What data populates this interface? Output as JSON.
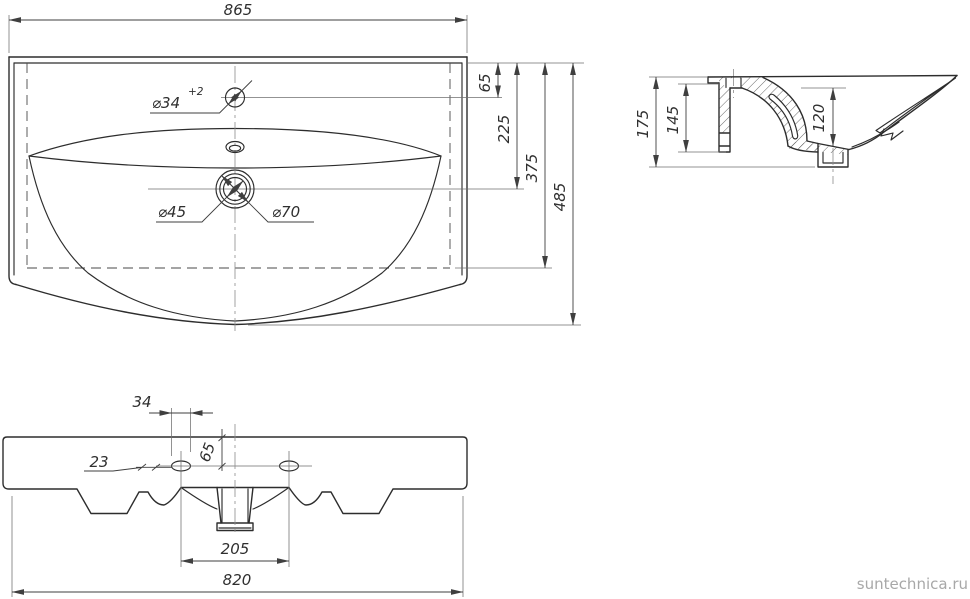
{
  "colors": {
    "line": "#2d2d2d",
    "dim": "#3f3f3f",
    "centerline": "#8c8c8c",
    "watermark": "#a8a8a8"
  },
  "plan_view": {
    "overall_width": "865",
    "faucet_hole_dia": "⌀34",
    "faucet_hole_tolerance": "+2",
    "drain_dia_inner": "⌀45",
    "drain_dia_outer": "⌀70"
  },
  "depth_chain": {
    "edge_to_faucet": "65",
    "edge_to_drain": "225",
    "edge_to_deck_back": "375",
    "overall_depth": "485"
  },
  "section_view": {
    "overall_height": "175",
    "inner_height": "145",
    "bowl_depth": "120"
  },
  "front_view": {
    "slot_length": "34",
    "offset": "23",
    "edge_to_holes": "65",
    "holes_spacing": "205",
    "mounting_width": "820"
  },
  "watermark": {
    "site": "suntechnica.ru"
  }
}
